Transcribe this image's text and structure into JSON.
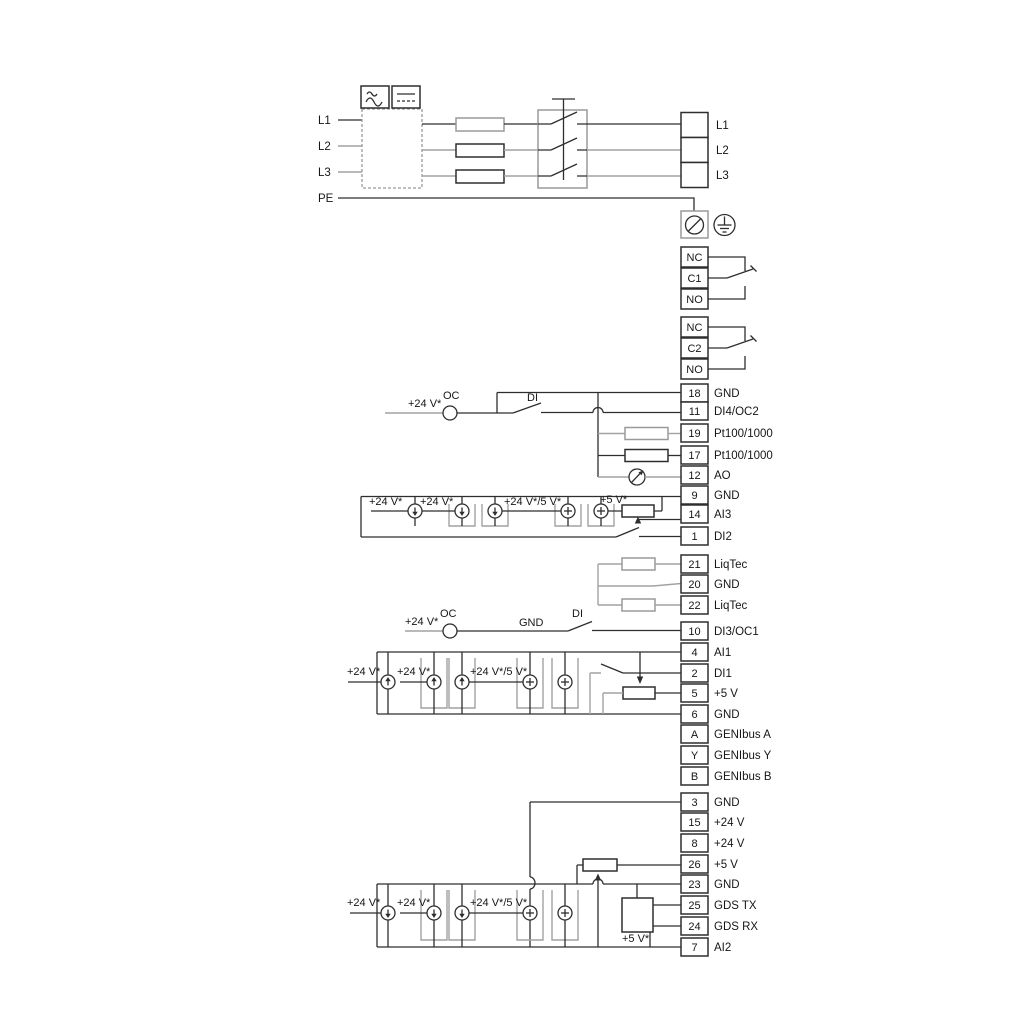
{
  "labels": {
    "l1": "L1",
    "l2": "L2",
    "l3": "L3",
    "pe": "PE"
  },
  "outputs": [
    {
      "label": "L1"
    },
    {
      "label": "L2"
    },
    {
      "label": "L3"
    }
  ],
  "relay1": [
    {
      "id": "NC"
    },
    {
      "id": "C1"
    },
    {
      "id": "NO"
    }
  ],
  "relay2": [
    {
      "id": "NC"
    },
    {
      "id": "C2"
    },
    {
      "id": "NO"
    }
  ],
  "io1": [
    {
      "id": "18",
      "label": "GND"
    },
    {
      "id": "11",
      "label": "DI4/OC2"
    },
    {
      "id": "19",
      "label": "Pt100/1000"
    },
    {
      "id": "17",
      "label": "Pt100/1000"
    },
    {
      "id": "12",
      "label": "AO"
    },
    {
      "id": "9",
      "label": "GND"
    },
    {
      "id": "14",
      "label": "AI3"
    },
    {
      "id": "1",
      "label": "DI2"
    }
  ],
  "liqtec": [
    {
      "id": "21",
      "label": "LiqTec"
    },
    {
      "id": "20",
      "label": "GND"
    },
    {
      "id": "22",
      "label": "LiqTec"
    }
  ],
  "io2": [
    {
      "id": "10",
      "label": "DI3/OC1"
    },
    {
      "id": "4",
      "label": "AI1"
    },
    {
      "id": "2",
      "label": "DI1"
    },
    {
      "id": "5",
      "label": "+5 V"
    },
    {
      "id": "6",
      "label": "GND"
    },
    {
      "id": "A",
      "label": "GENIbus A"
    },
    {
      "id": "Y",
      "label": "GENIbus Y"
    },
    {
      "id": "B",
      "label": "GENIbus B"
    }
  ],
  "io3": [
    {
      "id": "3",
      "label": "GND"
    },
    {
      "id": "15",
      "label": "+24 V"
    },
    {
      "id": "8",
      "label": "+24 V"
    },
    {
      "id": "26",
      "label": "+5 V"
    },
    {
      "id": "23",
      "label": "GND"
    },
    {
      "id": "25",
      "label": "GDS TX"
    },
    {
      "id": "24",
      "label": "GDS RX"
    },
    {
      "id": "7",
      "label": "AI2"
    }
  ],
  "ann": {
    "p24": "+24 V*",
    "p24_5": "+24 V*/5 V*",
    "p5": "+5 V*",
    "oc": "OC",
    "di": "DI",
    "gnd": "GND"
  }
}
